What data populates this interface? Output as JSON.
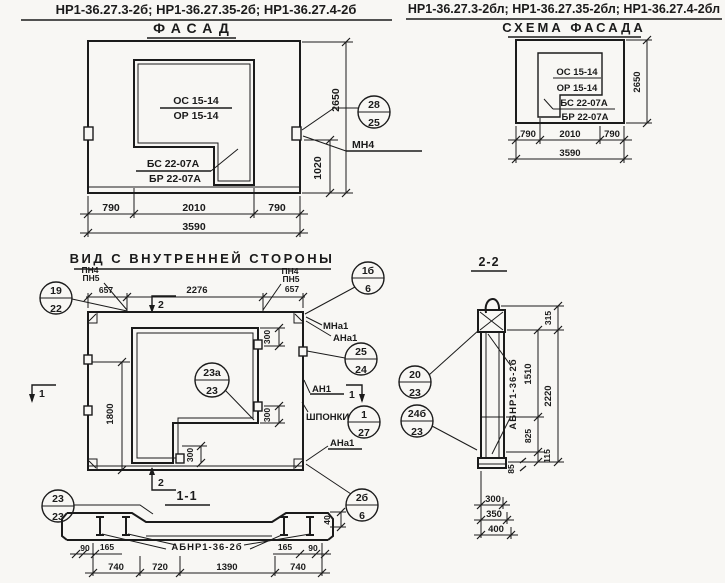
{
  "titles": {
    "left": "НР1-36.27.3-2б; НР1-36.27.35-2б; НР1-36.27.4-2б",
    "right": "НР1-36.27.3-2бл; НР1-36.27.35-2бл; НР1-36.27.4-2бл"
  },
  "facade": {
    "title": "ФАСАД",
    "os": "ОС 15-14",
    "or": "ОР 15-14",
    "bs": "БС 22-07А",
    "br": "БР 22-07А",
    "c28": "28",
    "c25": "25",
    "mn4": "МН4",
    "d2650": "2650",
    "d1020": "1020",
    "d790l": "790",
    "d2010": "2010",
    "d790r": "790",
    "d3590": "3590"
  },
  "schema": {
    "title": "СХЕМА ФАСАДА",
    "os": "ОС 15-14",
    "or": "ОР 15-14",
    "bs": "БС 22-07А",
    "br": "БР 22-07А",
    "d2650": "2650",
    "d790l": "790",
    "d2010": "2010",
    "d790r": "790",
    "d3590": "3590"
  },
  "inner": {
    "title": "ВИД С ВНУТРЕННЕЙ СТОРОНЫ",
    "c19": "19",
    "c22": "22",
    "pn4l": "ПН4",
    "pn5l": "ПН5",
    "d657l": "657",
    "d2276": "2276",
    "pn4r": "ПН4",
    "pn5r": "ПН5",
    "d657r": "657",
    "c1b": "1б",
    "c1b_d": "6",
    "mna1": "МНа1",
    "ana1": "АНа1",
    "c25": "25",
    "c24": "24",
    "an1": "АН1",
    "m1l": "1",
    "m1r": "1",
    "shponki": "ШПОНКИ",
    "c1": "1",
    "c27": "27",
    "ana1b": "АНа1",
    "c23a": "23а",
    "c23a_d": "23",
    "d1800": "1800",
    "d300a": "300",
    "d300b": "300",
    "d300c": "300",
    "m2t": "2",
    "m2b": "2",
    "c23": "23",
    "c23_d": "23",
    "c2b": "2б",
    "c2b_d": "6"
  },
  "s11": {
    "title": "1-1",
    "label": "АБНР1-36-2б",
    "d90l": "90",
    "d165l": "165",
    "d165r": "165",
    "d90r": "90",
    "d740l": "740",
    "d720": "720",
    "d1390": "1390",
    "d740r": "740",
    "d40": "40"
  },
  "s22": {
    "title": "2-2",
    "label": "АБНР1-36-2б",
    "c20": "20",
    "c20_d": "23",
    "c24b": "24б",
    "c24b_d": "23",
    "d315": "315",
    "d2220": "2220",
    "d1510": "1510",
    "d825": "825",
    "d115": "115",
    "d85": "85",
    "d300": "300",
    "d350": "350",
    "d400": "400"
  }
}
